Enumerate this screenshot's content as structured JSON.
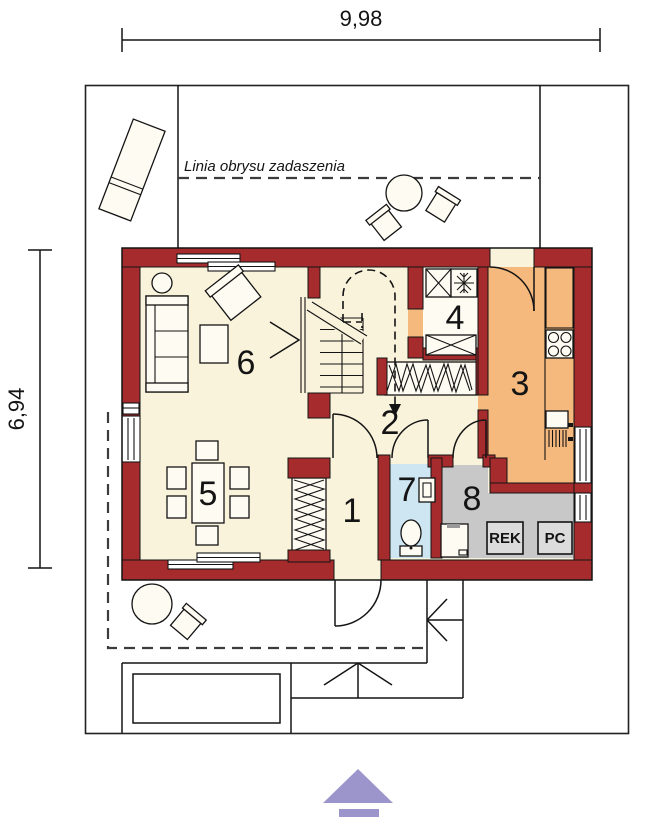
{
  "dimensions": {
    "width": "9,98",
    "height": "6,94"
  },
  "canopy_label": "Linia obrysu zadaszenia",
  "rooms": [
    {
      "number": "1"
    },
    {
      "number": "2"
    },
    {
      "number": "3"
    },
    {
      "number": "4"
    },
    {
      "number": "5"
    },
    {
      "number": "6"
    },
    {
      "number": "7"
    },
    {
      "number": "8"
    }
  ],
  "equipment": {
    "rek": "REK",
    "pc": "PC"
  },
  "colors": {
    "wall": "#A62B2D",
    "floor": "#FAF3DC",
    "floor2": "#FDFBF2",
    "kitchen": "#F5B87D",
    "bath": "#CEE5F2",
    "utility": "#C8C8C8",
    "box": "#DCDCDC",
    "arrow": "#9B95CB",
    "line": "#141414"
  }
}
